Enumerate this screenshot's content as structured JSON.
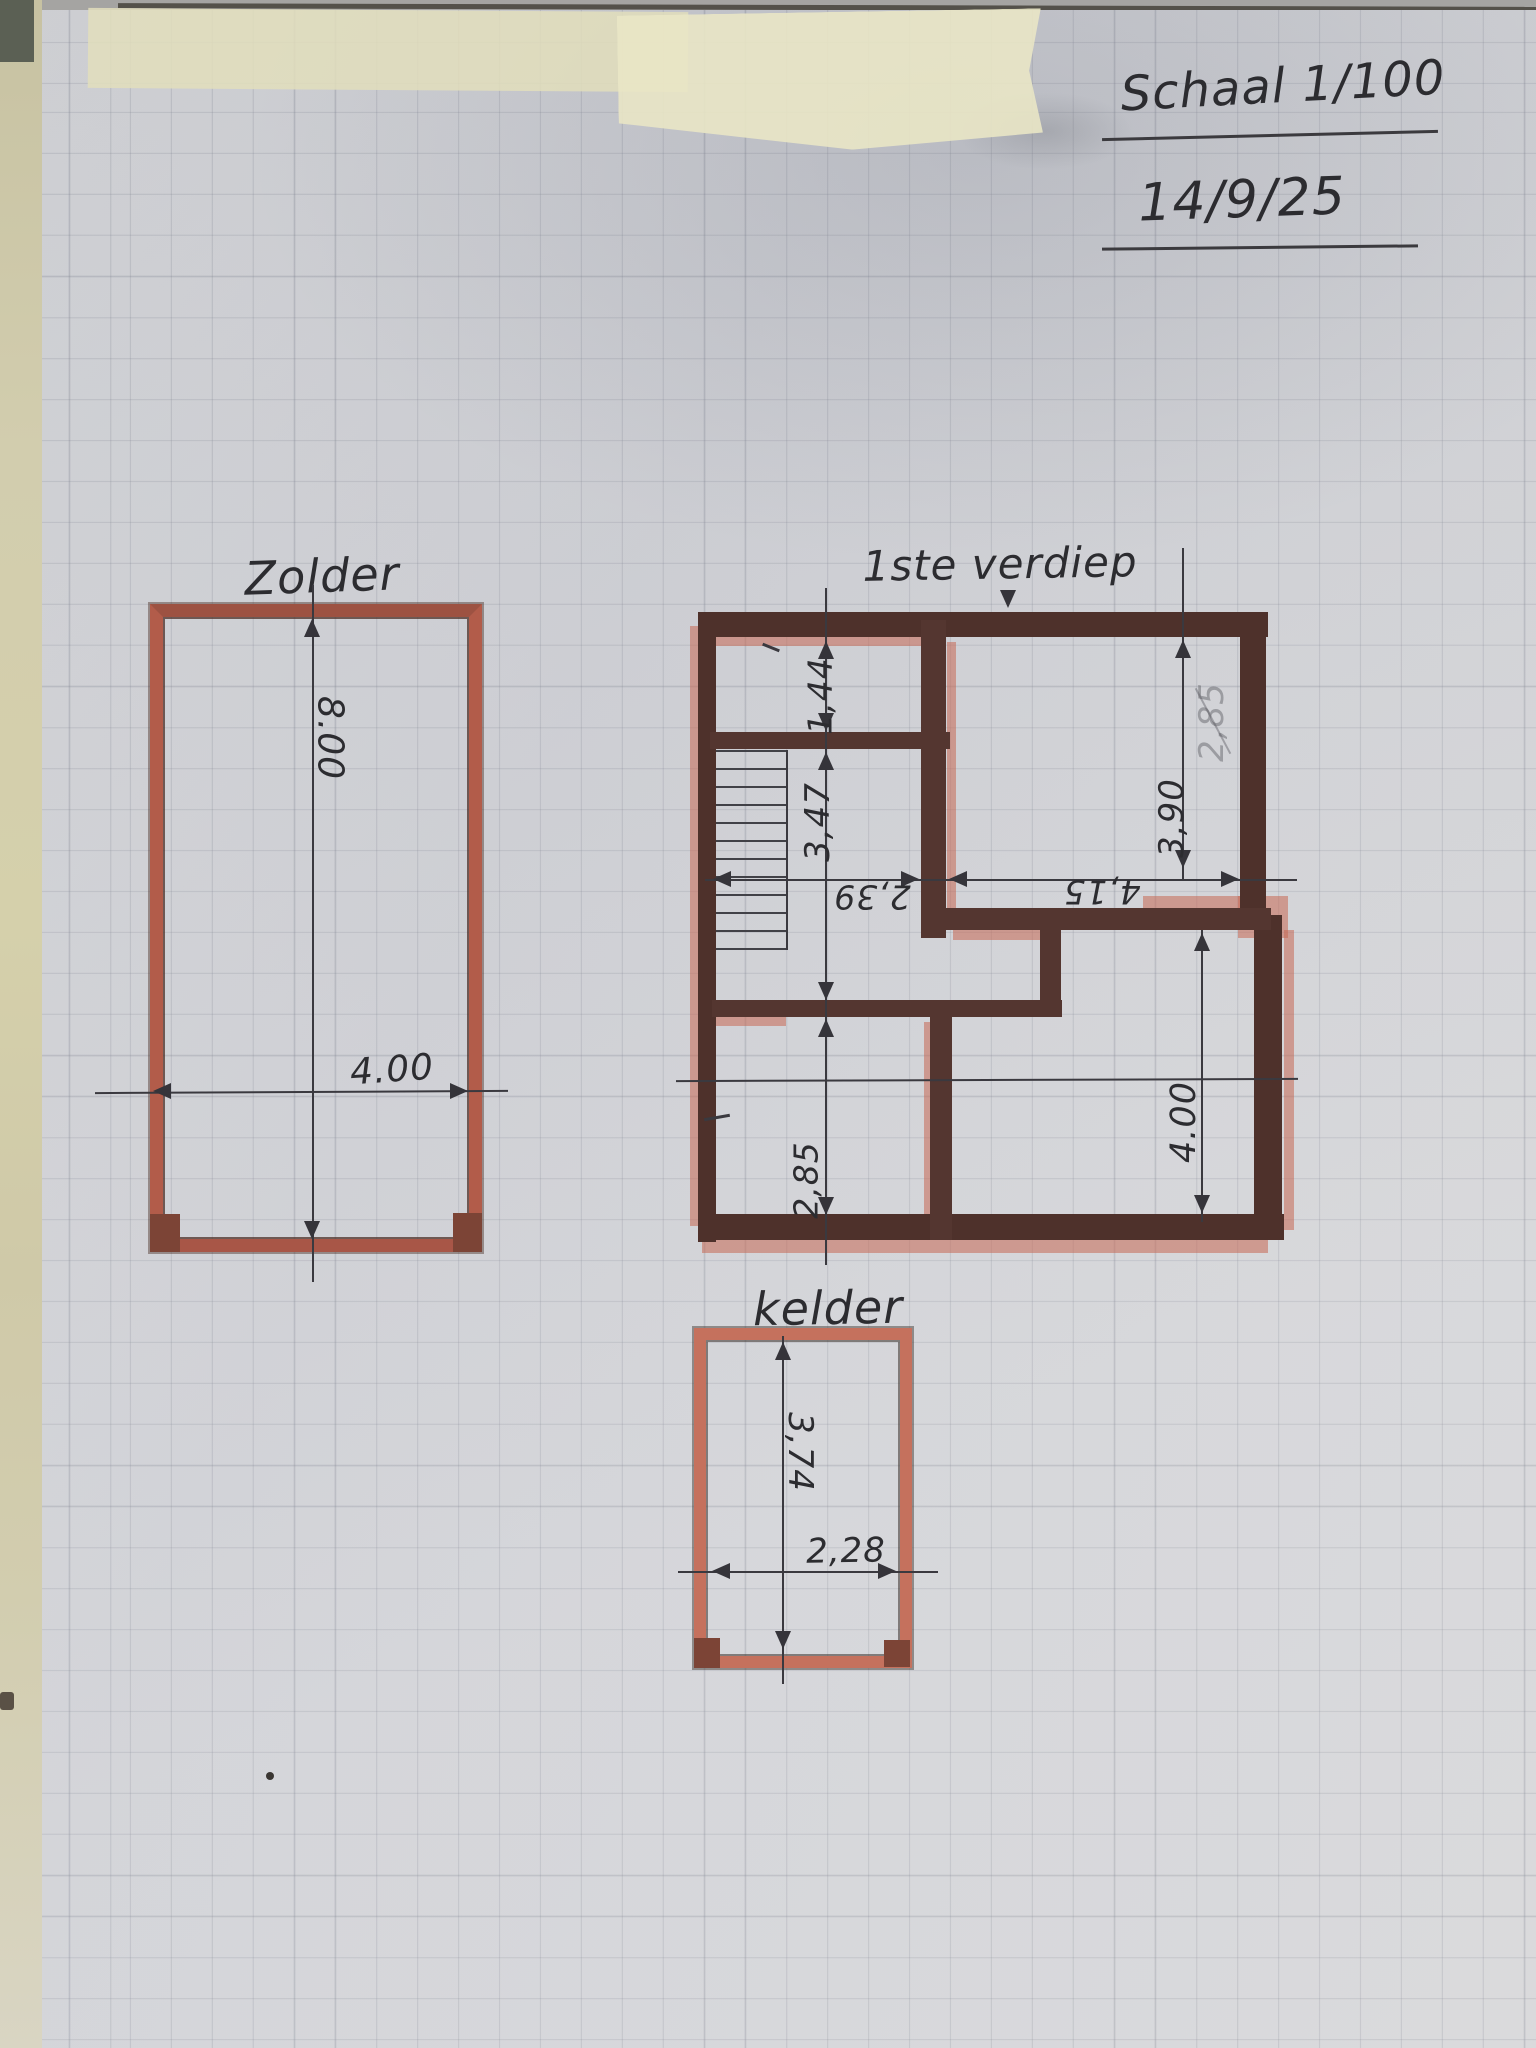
{
  "title": {
    "scale": "Schaal 1/100",
    "date": "14/9/25"
  },
  "plans": {
    "zolder": {
      "label": "Zolder",
      "width": "4.00",
      "height": "8.00"
    },
    "first_floor": {
      "label": "1ste verdiep",
      "top_room_depth": "1,44",
      "stair_hall_depth": "3,47",
      "stair_hall_width": "2,39",
      "right_room_width": "4,15",
      "right_room_depth": "3,90",
      "bottom_left_room_depth": "2,85",
      "bottom_right_room_depth": "4.00",
      "faint_crossed_out": "2,85"
    },
    "kelder": {
      "label": "kelder",
      "width": "2,28",
      "height": "3,74"
    }
  },
  "colors": {
    "wall_dark": "#543630",
    "marker_salmon": "#c66854",
    "pencil": "#3a393f",
    "paper": "#d2d3d7",
    "tape": "#e9e6c5"
  }
}
